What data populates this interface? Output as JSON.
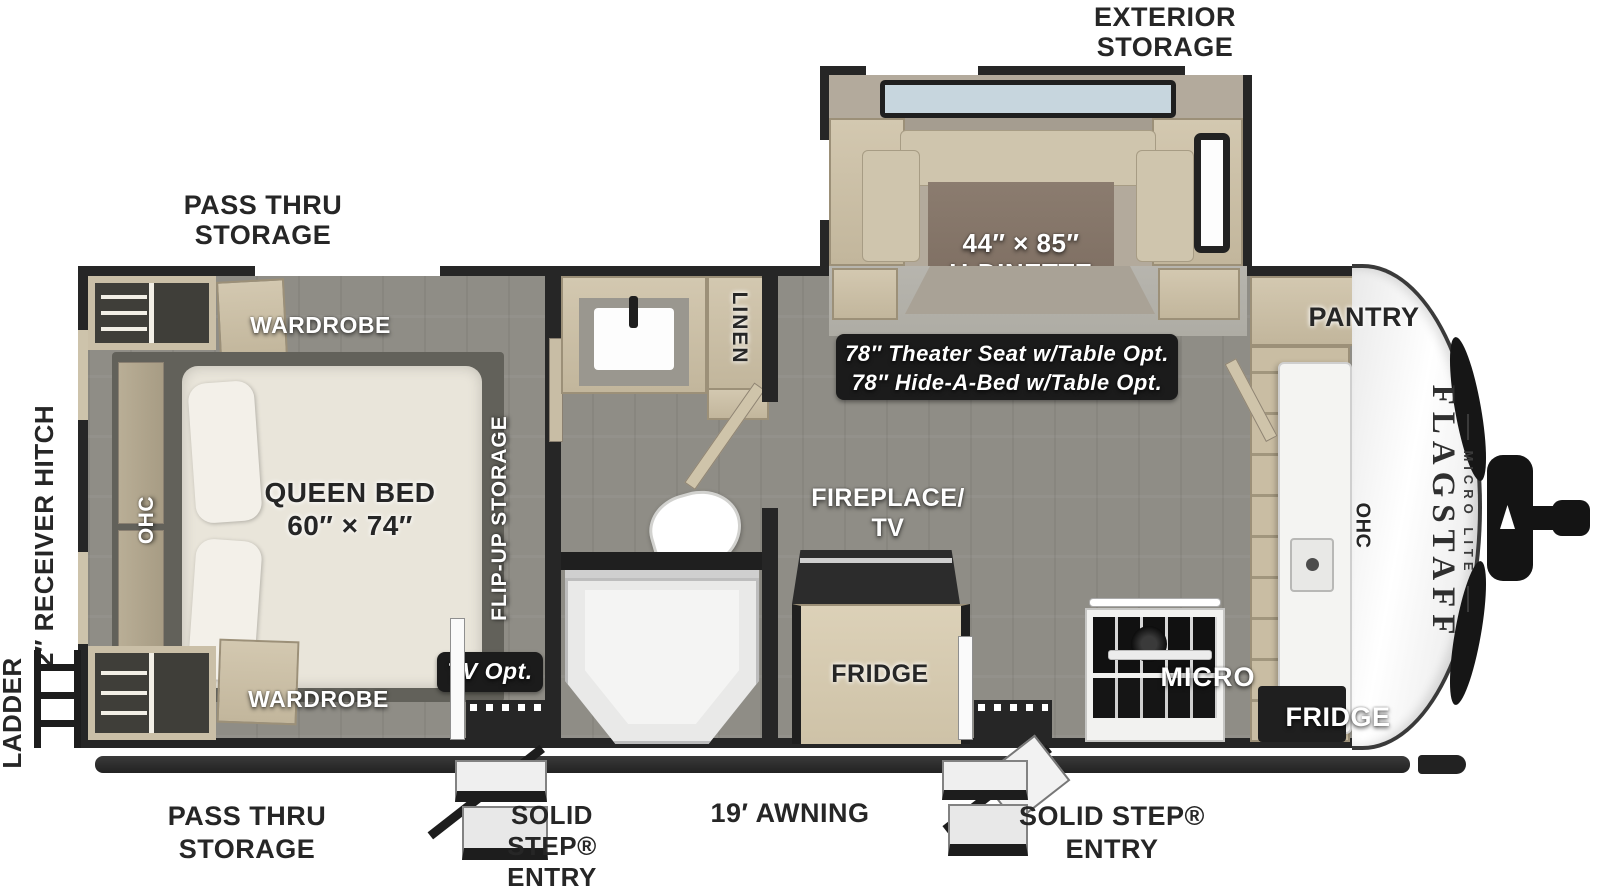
{
  "brand": {
    "name": "FLAGSTAFF",
    "sub": "MICRO LITE"
  },
  "exterior": {
    "exterior_storage_l1": "EXTERIOR",
    "exterior_storage_l2": "STORAGE",
    "pass_thru_top_l1": "PASS THRU",
    "pass_thru_top_l2": "STORAGE",
    "pass_thru_bottom_l1": "PASS THRU",
    "pass_thru_bottom_l2": "STORAGE",
    "ladder": "LADDER",
    "receiver_hitch": "2″ RECEIVER HITCH",
    "awning": "19′ AWNING",
    "step_left_l1": "SOLID",
    "step_left_l2": "STEP®",
    "step_left_l3": "ENTRY",
    "step_right_l1": "SOLID STEP®",
    "step_right_l2": "ENTRY"
  },
  "bedroom": {
    "wardrobe_top": "WARDROBE",
    "wardrobe_bottom": "WARDROBE",
    "bed_l1": "QUEEN BED",
    "bed_l2": "60″ × 74″",
    "ohc": "OHC",
    "flip_up": "FLIP-UP STORAGE",
    "tv_opt": "TV Opt."
  },
  "bath": {
    "linen": "LINEN"
  },
  "living": {
    "fireplace_l1": "FIREPLACE/",
    "fireplace_l2": "TV",
    "fridge": "FRIDGE",
    "theater_l1": "78″ Theater Seat w/Table Opt.",
    "theater_l2": "78″ Hide-A-Bed w/Table Opt.",
    "dinette_l1": "44″ × 85″",
    "dinette_l2": "U-DINETTE"
  },
  "kitchen": {
    "pantry": "PANTRY",
    "ohc": "OHC",
    "micro": "MICRO",
    "fridge": "FRIDGE"
  },
  "colors": {
    "wall": "#262626",
    "wood": "#cdc2aa",
    "table": "#84756a",
    "floor": "#8f8d86",
    "slide_floor": "#b3aa9c",
    "label_box": "#1b1b1b",
    "mattress": "#e9e5da",
    "skylight": "#c7d6de"
  }
}
